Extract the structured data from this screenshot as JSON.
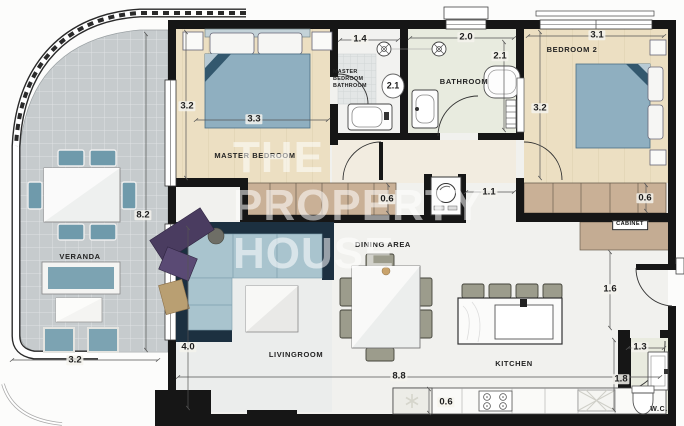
{
  "watermark": {
    "line1": "THE",
    "line2": "PROPERTY",
    "line3": "HOUSE"
  },
  "rooms": {
    "master_bedroom": {
      "label": "MASTER BEDROOM",
      "width": "3.3",
      "height": "3.2"
    },
    "master_bathroom": {
      "label_line1": "MASTER",
      "label_line2": "BEDROOM",
      "label_line3": "BATHROOM",
      "width": "1.4",
      "depth": "2.1"
    },
    "bathroom": {
      "label": "BATHROOM",
      "width": "2.0",
      "depth": "2.1"
    },
    "bedroom2": {
      "label": "BEDROOM 2",
      "width": "3.1",
      "height": "3.2"
    },
    "veranda": {
      "label": "VERANDA",
      "length": "8.2",
      "width": "3.2"
    },
    "livingroom": {
      "label": "LIVINGROOM",
      "height": "4.0"
    },
    "dining": {
      "label": "DINING AREA"
    },
    "kitchen": {
      "label": "KITCHEN",
      "counter_depth": "0.6"
    },
    "wc": {
      "label": "W.C.",
      "width": "1.3",
      "height": "1.8"
    }
  },
  "dims": {
    "master_closet_depth": "0.6",
    "bedroom2_closet_depth": "0.6",
    "hall_width": "1.1",
    "hall_cabinet_width": "1.6",
    "total_width": "8.8"
  },
  "labels": {
    "cabinet": "CABINET"
  }
}
